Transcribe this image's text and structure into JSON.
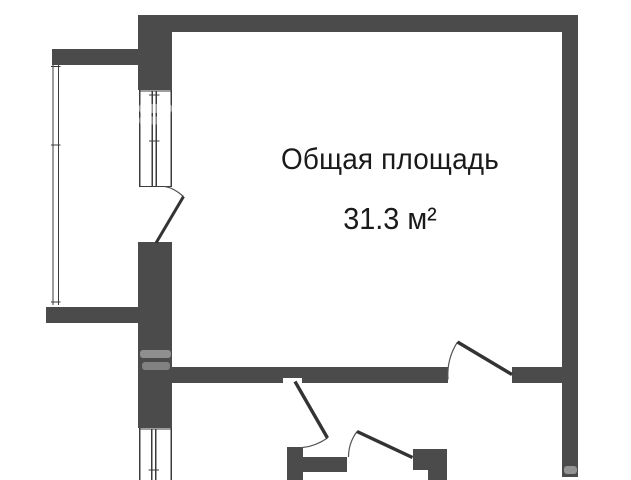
{
  "floorplan": {
    "label": {
      "line1": "Общая площадь",
      "line2": "31.3 м²"
    },
    "colors": {
      "wall": "#4b4b4b",
      "line": "#3c3c3c",
      "leaf": "#333333",
      "arc": "#555555",
      "text": "#1a1a1a",
      "background": "#ffffff",
      "watermark": "#ffffff"
    }
  }
}
